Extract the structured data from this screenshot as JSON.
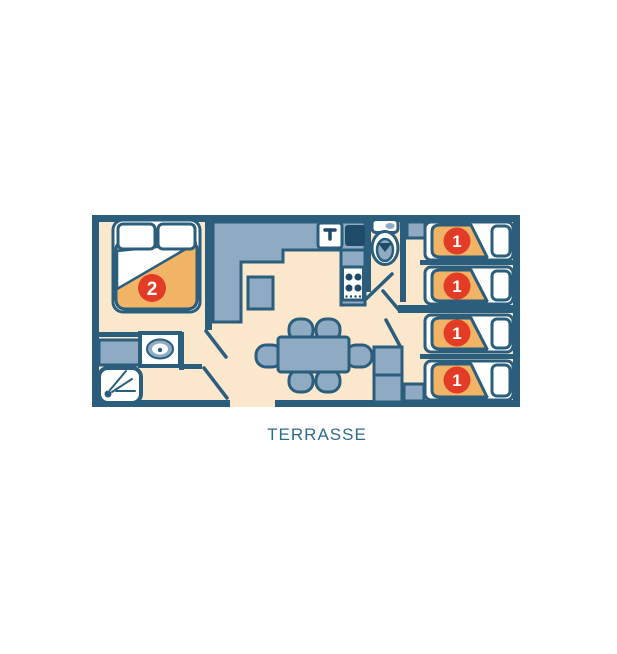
{
  "plan": {
    "terrace_label": "TERRASSE",
    "master_bedroom": {
      "badge": "2"
    },
    "single_beds": [
      {
        "badge": "1"
      },
      {
        "badge": "1"
      },
      {
        "badge": "1"
      },
      {
        "badge": "1"
      }
    ],
    "colors": {
      "wall": "#2a5e7c",
      "floor": "#fbe7cb",
      "furniture": "#8fabc3",
      "appliance_dark": "#1f4a68",
      "blanket_orange": "#f1b366",
      "badge_red": "#e23c27",
      "label_teal": "#2f6a89"
    },
    "furniture_icons": [
      "double-bed-icon",
      "pillow-icon",
      "single-bed-icon",
      "kitchen-counter-icon",
      "sink-faucet-icon",
      "fridge-icon",
      "stove-icon",
      "toilet-icon",
      "washbasin-icon",
      "shower-icon",
      "dining-table-icon",
      "chair-icon",
      "wardrobe-icon",
      "door-swing-icon"
    ]
  }
}
